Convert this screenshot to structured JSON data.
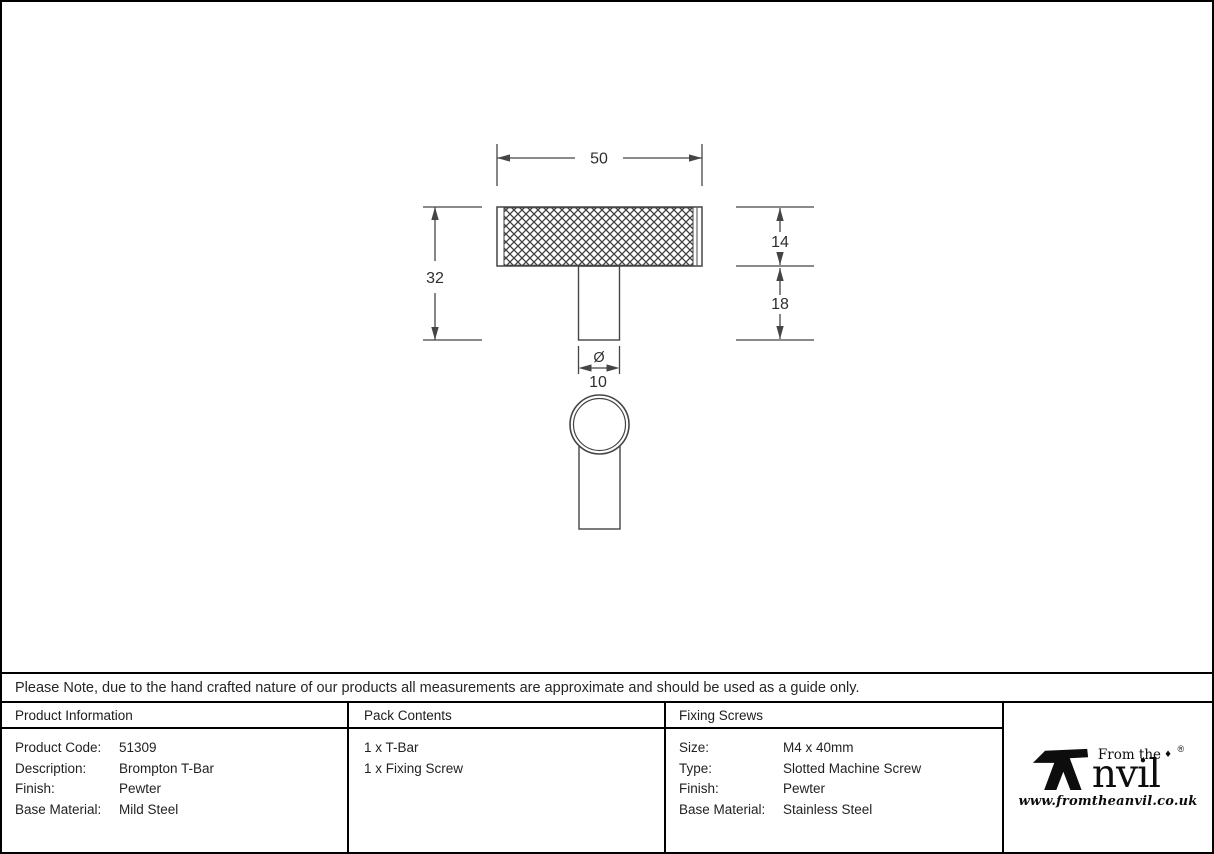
{
  "drawing": {
    "dim_total_width": "50",
    "dim_total_height": "32",
    "dim_bar_height": "14",
    "dim_stem_height": "18",
    "dim_diameter_symbol": "Ø",
    "dim_diameter_value": "10"
  },
  "note": "Please Note, due to the hand crafted nature of our products all measurements are approximate and should be used as a guide only.",
  "table": {
    "product_information": {
      "header": "Product Information",
      "rows": [
        {
          "label": "Product Code:",
          "value": "51309"
        },
        {
          "label": "Description:",
          "value": "Brompton T-Bar"
        },
        {
          "label": "Finish:",
          "value": "Pewter"
        },
        {
          "label": "Base Material:",
          "value": "Mild Steel"
        }
      ]
    },
    "pack_contents": {
      "header": "Pack Contents",
      "items": [
        "1 x T-Bar",
        "1 x Fixing Screw"
      ]
    },
    "fixing_screws": {
      "header": "Fixing Screws",
      "rows": [
        {
          "label": "Size:",
          "value": "M4 x 40mm"
        },
        {
          "label": "Type:",
          "value": "Slotted Machine Screw"
        },
        {
          "label": "Finish:",
          "value": "Pewter"
        },
        {
          "label": "Base Material:",
          "value": "Stainless Steel"
        }
      ]
    }
  },
  "logo": {
    "icon": "anvil-icon",
    "tagline": "From the",
    "diamond": "♦",
    "name_rest": "nvil",
    "registered": "®",
    "website": "www.fromtheanvil.co.uk"
  },
  "colors": {
    "drawing_line": "#454545",
    "border": "#000000",
    "text": "#1f1f1f"
  }
}
